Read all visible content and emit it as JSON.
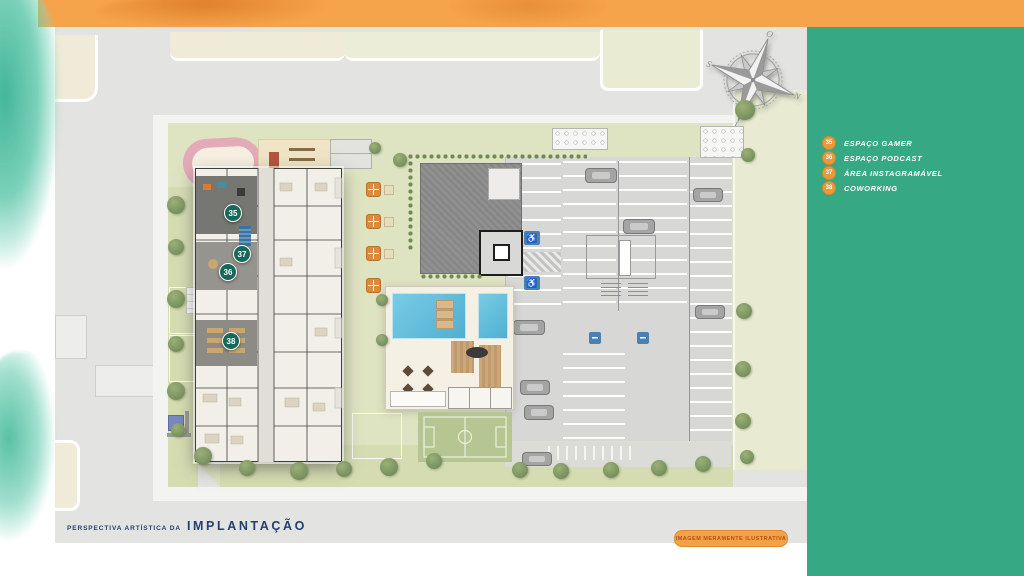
{
  "colors": {
    "top_bar": "#F6A44C",
    "side_panel": "#36A884",
    "legend_badge": "#E89A3B",
    "map_marker": "#17685A",
    "accessible_blue": "#4B80B3",
    "pool_blue": "#5FBEDC",
    "caption_navy": "#24406E",
    "disclaimer_orange": "#F5A044"
  },
  "side_panel": {
    "legend": [
      {
        "number": "35",
        "label": "ESPAÇO GAMER"
      },
      {
        "number": "36",
        "label": "ESPAÇO PODCAST"
      },
      {
        "number": "37",
        "label": "ÁREA INSTAGRAMÁVEL"
      },
      {
        "number": "38",
        "label": "COWORKING"
      }
    ]
  },
  "map": {
    "markers": [
      {
        "number": "35"
      },
      {
        "number": "37"
      },
      {
        "number": "36"
      },
      {
        "number": "38"
      }
    ],
    "compass": {
      "top": "O",
      "right": "N",
      "bottom": "L",
      "left": "S"
    },
    "parking": {
      "accessible_icon": "♿"
    },
    "caption": {
      "prefix": "PERSPECTIVA ARTÍSTICA DA",
      "title": "IMPLANTAÇÃO"
    },
    "disclaimer": "IMAGEM MERAMENTE ILUSTRATIVA"
  }
}
